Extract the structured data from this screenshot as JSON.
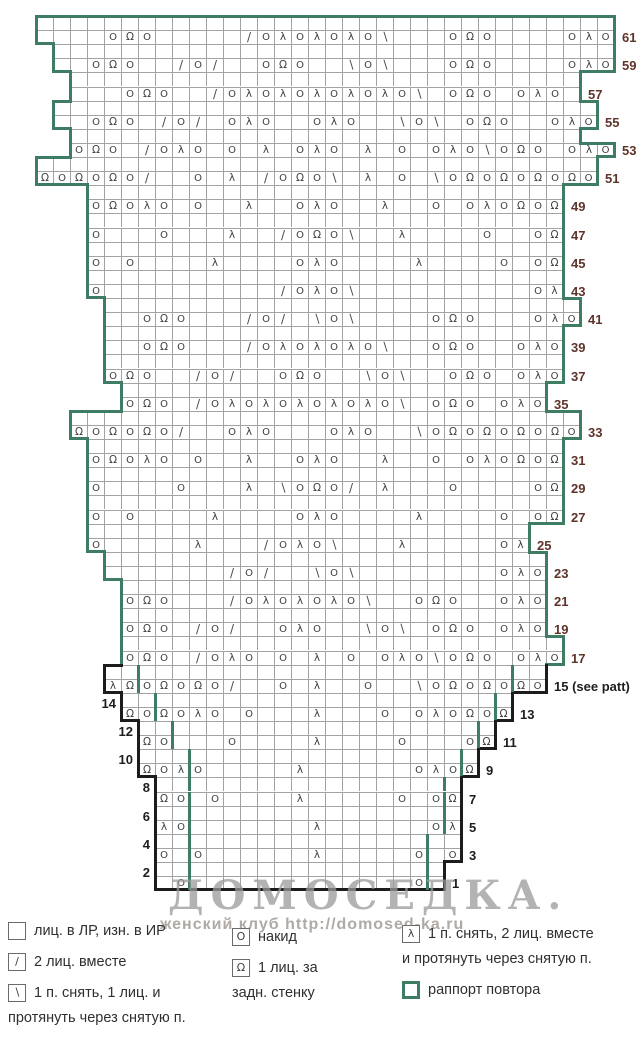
{
  "watermark": {
    "title": "ДОМОСЕДКА.",
    "subtitle": "женский клуб http://domosed-ka.ru"
  },
  "colors": {
    "repeat_green": "#3e7c63",
    "outline_black": "#1c1c1c",
    "grid": "#a3a3a3",
    "symbol": "#3d3d3d",
    "label_maroon": "#5e342a"
  },
  "chart": {
    "cols": 34,
    "cell_w": 17,
    "cell_h": 14.1,
    "origin_x": 36,
    "origin_y": 16,
    "glyphs": {
      "O": "O",
      "R": "Ω",
      "A": "λ",
      "/": "/",
      "B": "∖"
    },
    "rows": [
      {
        "s": 1,
        "w": 34
      },
      {
        "s": 1,
        "c": "....ORO...../OAOAOAOB...ORO....OAO",
        "n": "61"
      },
      {
        "s": 2,
        "w": 33
      },
      {
        "s": 2,
        "c": "..ORO../O/..ORO..BOB...ORO....OAO",
        "n": "59"
      },
      {
        "s": 3,
        "w": 30
      },
      {
        "s": 3,
        "c": "...ORO../OAOAOAOAOAOB.ORO.OAO.",
        "n": "57"
      },
      {
        "s": 2,
        "w": 32
      },
      {
        "s": 2,
        "c": "..ORO./O/.OAO..OAO..BOB.ORO..OAO",
        "n": "55"
      },
      {
        "s": 3,
        "w": 30
      },
      {
        "s": 3,
        "c": "ORO./OAO.O.A.OAO.A.O.OAOBORO.OAO",
        "n": "53"
      },
      {
        "s": 1,
        "w": 33
      },
      {
        "s": 1,
        "c": "RORORO/..O.A./OROB.A.O.BORORORORO",
        "n": "51"
      },
      {
        "s": 4,
        "w": 28
      },
      {
        "s": 4,
        "c": "OROAO.O..A..OAO..A..O.OAOROR",
        "n": "49"
      },
      {
        "s": 4,
        "w": 28
      },
      {
        "s": 4,
        "c": "O...O...A../OROB..A....O..OR",
        "n": "47"
      },
      {
        "s": 4,
        "w": 28
      },
      {
        "s": 4,
        "c": "O.O....A....OAO....A....O.OR",
        "n": "45"
      },
      {
        "s": 4,
        "w": 28
      },
      {
        "s": 4,
        "c": "O........../OAOB..........OA",
        "n": "43"
      },
      {
        "s": 5,
        "w": 28
      },
      {
        "s": 5,
        "c": "..ORO.../O/.BOB....ORO...OAO",
        "n": "41"
      },
      {
        "s": 5,
        "w": 27
      },
      {
        "s": 5,
        "c": "..ORO.../OAOAOAOB..ORO..OAO",
        "n": "39"
      },
      {
        "s": 5,
        "w": 27
      },
      {
        "s": 5,
        "c": "ORO../O/..ORO..BOB..ORO.OAO",
        "n": "37"
      },
      {
        "s": 6,
        "w": 25
      },
      {
        "s": 6,
        "c": "ORO./OAOAOAOAOAOB.ORO.OAO",
        "n": "35"
      },
      {
        "s": 3,
        "w": 30
      },
      {
        "s": 3,
        "c": "RORORO/..OAO...OAO..BORORORORO",
        "n": "33"
      },
      {
        "s": 4,
        "w": 28
      },
      {
        "s": 4,
        "c": "OROAO.O..A..OAO..A..O.OAOROR",
        "n": "31"
      },
      {
        "s": 4,
        "w": 28
      },
      {
        "s": 4,
        "c": "O....O...A.BORO/.A...O....OR",
        "n": "29"
      },
      {
        "s": 4,
        "w": 28
      },
      {
        "s": 4,
        "c": "O.O....A....OAO....A....O.OR",
        "n": "27"
      },
      {
        "s": 4,
        "w": 26
      },
      {
        "s": 4,
        "c": "O.....A.../OAOB...A.....OA",
        "n": "25"
      },
      {
        "s": 5,
        "w": 26
      },
      {
        "s": 5,
        "c": "......./O/..BOB........OAO",
        "n": "23"
      },
      {
        "s": 6,
        "w": 25
      },
      {
        "s": 6,
        "c": "ORO.../OAOAOAOB..ORO..OAO",
        "n": "21"
      },
      {
        "s": 6,
        "w": 25
      },
      {
        "s": 6,
        "c": "ORO./O/..OAO..BOB.ORO.OAO",
        "n": "19"
      },
      {
        "s": 6,
        "w": 26
      },
      {
        "s": 6,
        "c": "ORO./OAO.O.A.O.OAOBORO.OAO",
        "n": "17"
      },
      {
        "s": 5,
        "w": 26,
        "b": 1,
        "gl": 7,
        "gr": 29
      },
      {
        "s": 5,
        "c": "ARORORO/..O.A..O..BORORORO",
        "n": "15 (see patt)",
        "b": 1,
        "gl": 7,
        "gr": 29
      },
      {
        "s": 6,
        "w": 23,
        "b": 1,
        "ln": "14",
        "gl": 8,
        "gr": 28
      },
      {
        "s": 6,
        "c": "ROROAO.O...A...O.OAOROR",
        "n": "13",
        "b": 1,
        "gl": 8,
        "gr": 28
      },
      {
        "s": 7,
        "w": 21,
        "b": 1,
        "ln": "12",
        "gl": 9,
        "gr": 27
      },
      {
        "s": 7,
        "c": "RO...O....A....O...OR",
        "n": "11",
        "b": 1,
        "gl": 9,
        "gr": 27
      },
      {
        "s": 7,
        "w": 20,
        "b": 1,
        "ln": "10",
        "gl": 10,
        "gr": 26
      },
      {
        "s": 7,
        "c": "ROAO.....A......OAOR",
        "n": "9",
        "b": 1,
        "gl": 10,
        "gr": 26
      },
      {
        "s": 8,
        "w": 18,
        "b": 1,
        "ln": "8",
        "gl": 10,
        "gr": 25
      },
      {
        "s": 8,
        "c": "RO.O....A.....O.OR",
        "n": "7",
        "b": 1,
        "gl": 10,
        "gr": 25
      },
      {
        "s": 8,
        "w": 18,
        "b": 1,
        "ln": "6",
        "gl": 10,
        "gr": 25
      },
      {
        "s": 8,
        "c": "AO.......A......OA",
        "n": "5",
        "b": 1,
        "gl": 10,
        "gr": 25
      },
      {
        "s": 8,
        "w": 18,
        "b": 1,
        "ln": "4",
        "gl": 10,
        "gr": 24
      },
      {
        "s": 8,
        "c": "O.O......A.....O.O",
        "n": "3",
        "b": 1,
        "gl": 10,
        "gr": 24
      },
      {
        "s": 8,
        "w": 17,
        "b": 1,
        "ln": "2",
        "gl": 10,
        "gr": 24
      },
      {
        "s": 8,
        "c": ".O.............O.",
        "n": "1",
        "b": 1,
        "gl": 10,
        "gr": 24
      }
    ]
  },
  "legend": {
    "columns": [
      {
        "x": 8,
        "y": 922,
        "w": 225,
        "items": [
          {
            "sym": ".",
            "lines": [
              "лиц. в ЛР, изн. в ИР"
            ]
          },
          {
            "sym": "/",
            "lines": [
              "2 лиц. вместе"
            ]
          },
          {
            "sym": "B",
            "lines": [
              "1 п. снять, 1 лиц. и",
              "протянуть через снятую п."
            ]
          }
        ]
      },
      {
        "x": 232,
        "y": 928,
        "w": 170,
        "items": [
          {
            "sym": "O",
            "lines": [
              "накид"
            ]
          },
          {
            "sym": "R",
            "lines": [
              "1 лиц. за",
              "задн. стенку"
            ]
          }
        ]
      },
      {
        "x": 402,
        "y": 925,
        "w": 235,
        "items": [
          {
            "sym": "A",
            "lines": [
              "1 п. снять, 2 лиц. вместе",
              "и протянуть через снятую п."
            ]
          },
          {
            "sym": "green",
            "lines": [
              "раппорт повтора"
            ]
          }
        ]
      }
    ]
  }
}
